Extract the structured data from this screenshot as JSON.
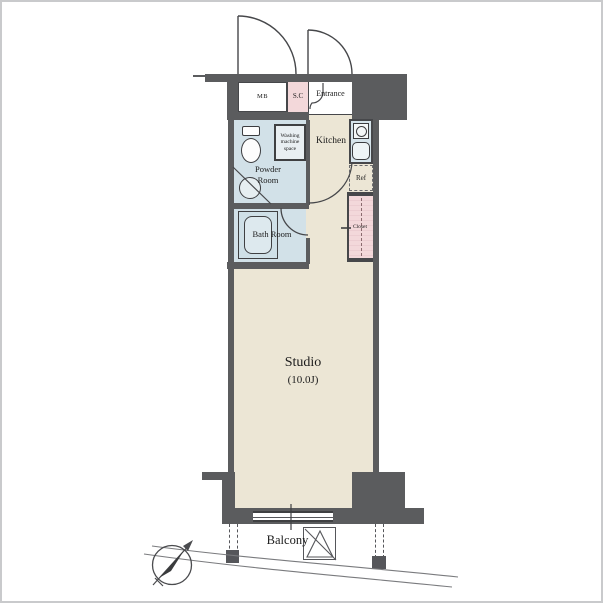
{
  "rooms": {
    "mb": "MB",
    "shoe_closet": "S.C",
    "entrance": "Entrance",
    "washing_machine": "Washing machine space",
    "kitchen": "Kitchen",
    "powder_room": "Powder Room",
    "refrigerator": "Ref",
    "bath_room": "Bath Room",
    "closet": "Closet",
    "studio": "Studio",
    "studio_area": "(10.0J)",
    "balcony": "Balcony"
  },
  "icons": {
    "compass": "compass-north-arrow",
    "evacuation_hatch": "triangle-in-square",
    "stove": "circle-in-square",
    "sink": "rounded-square"
  },
  "colors": {
    "wall": "#5b5c5e",
    "floor": "#ece6d5",
    "wet_area": "#d2e1e8",
    "accent_pink": "#f3d8da",
    "counter": "#d6e4eb",
    "line": "#444444",
    "frame": "#c9cacc"
  }
}
